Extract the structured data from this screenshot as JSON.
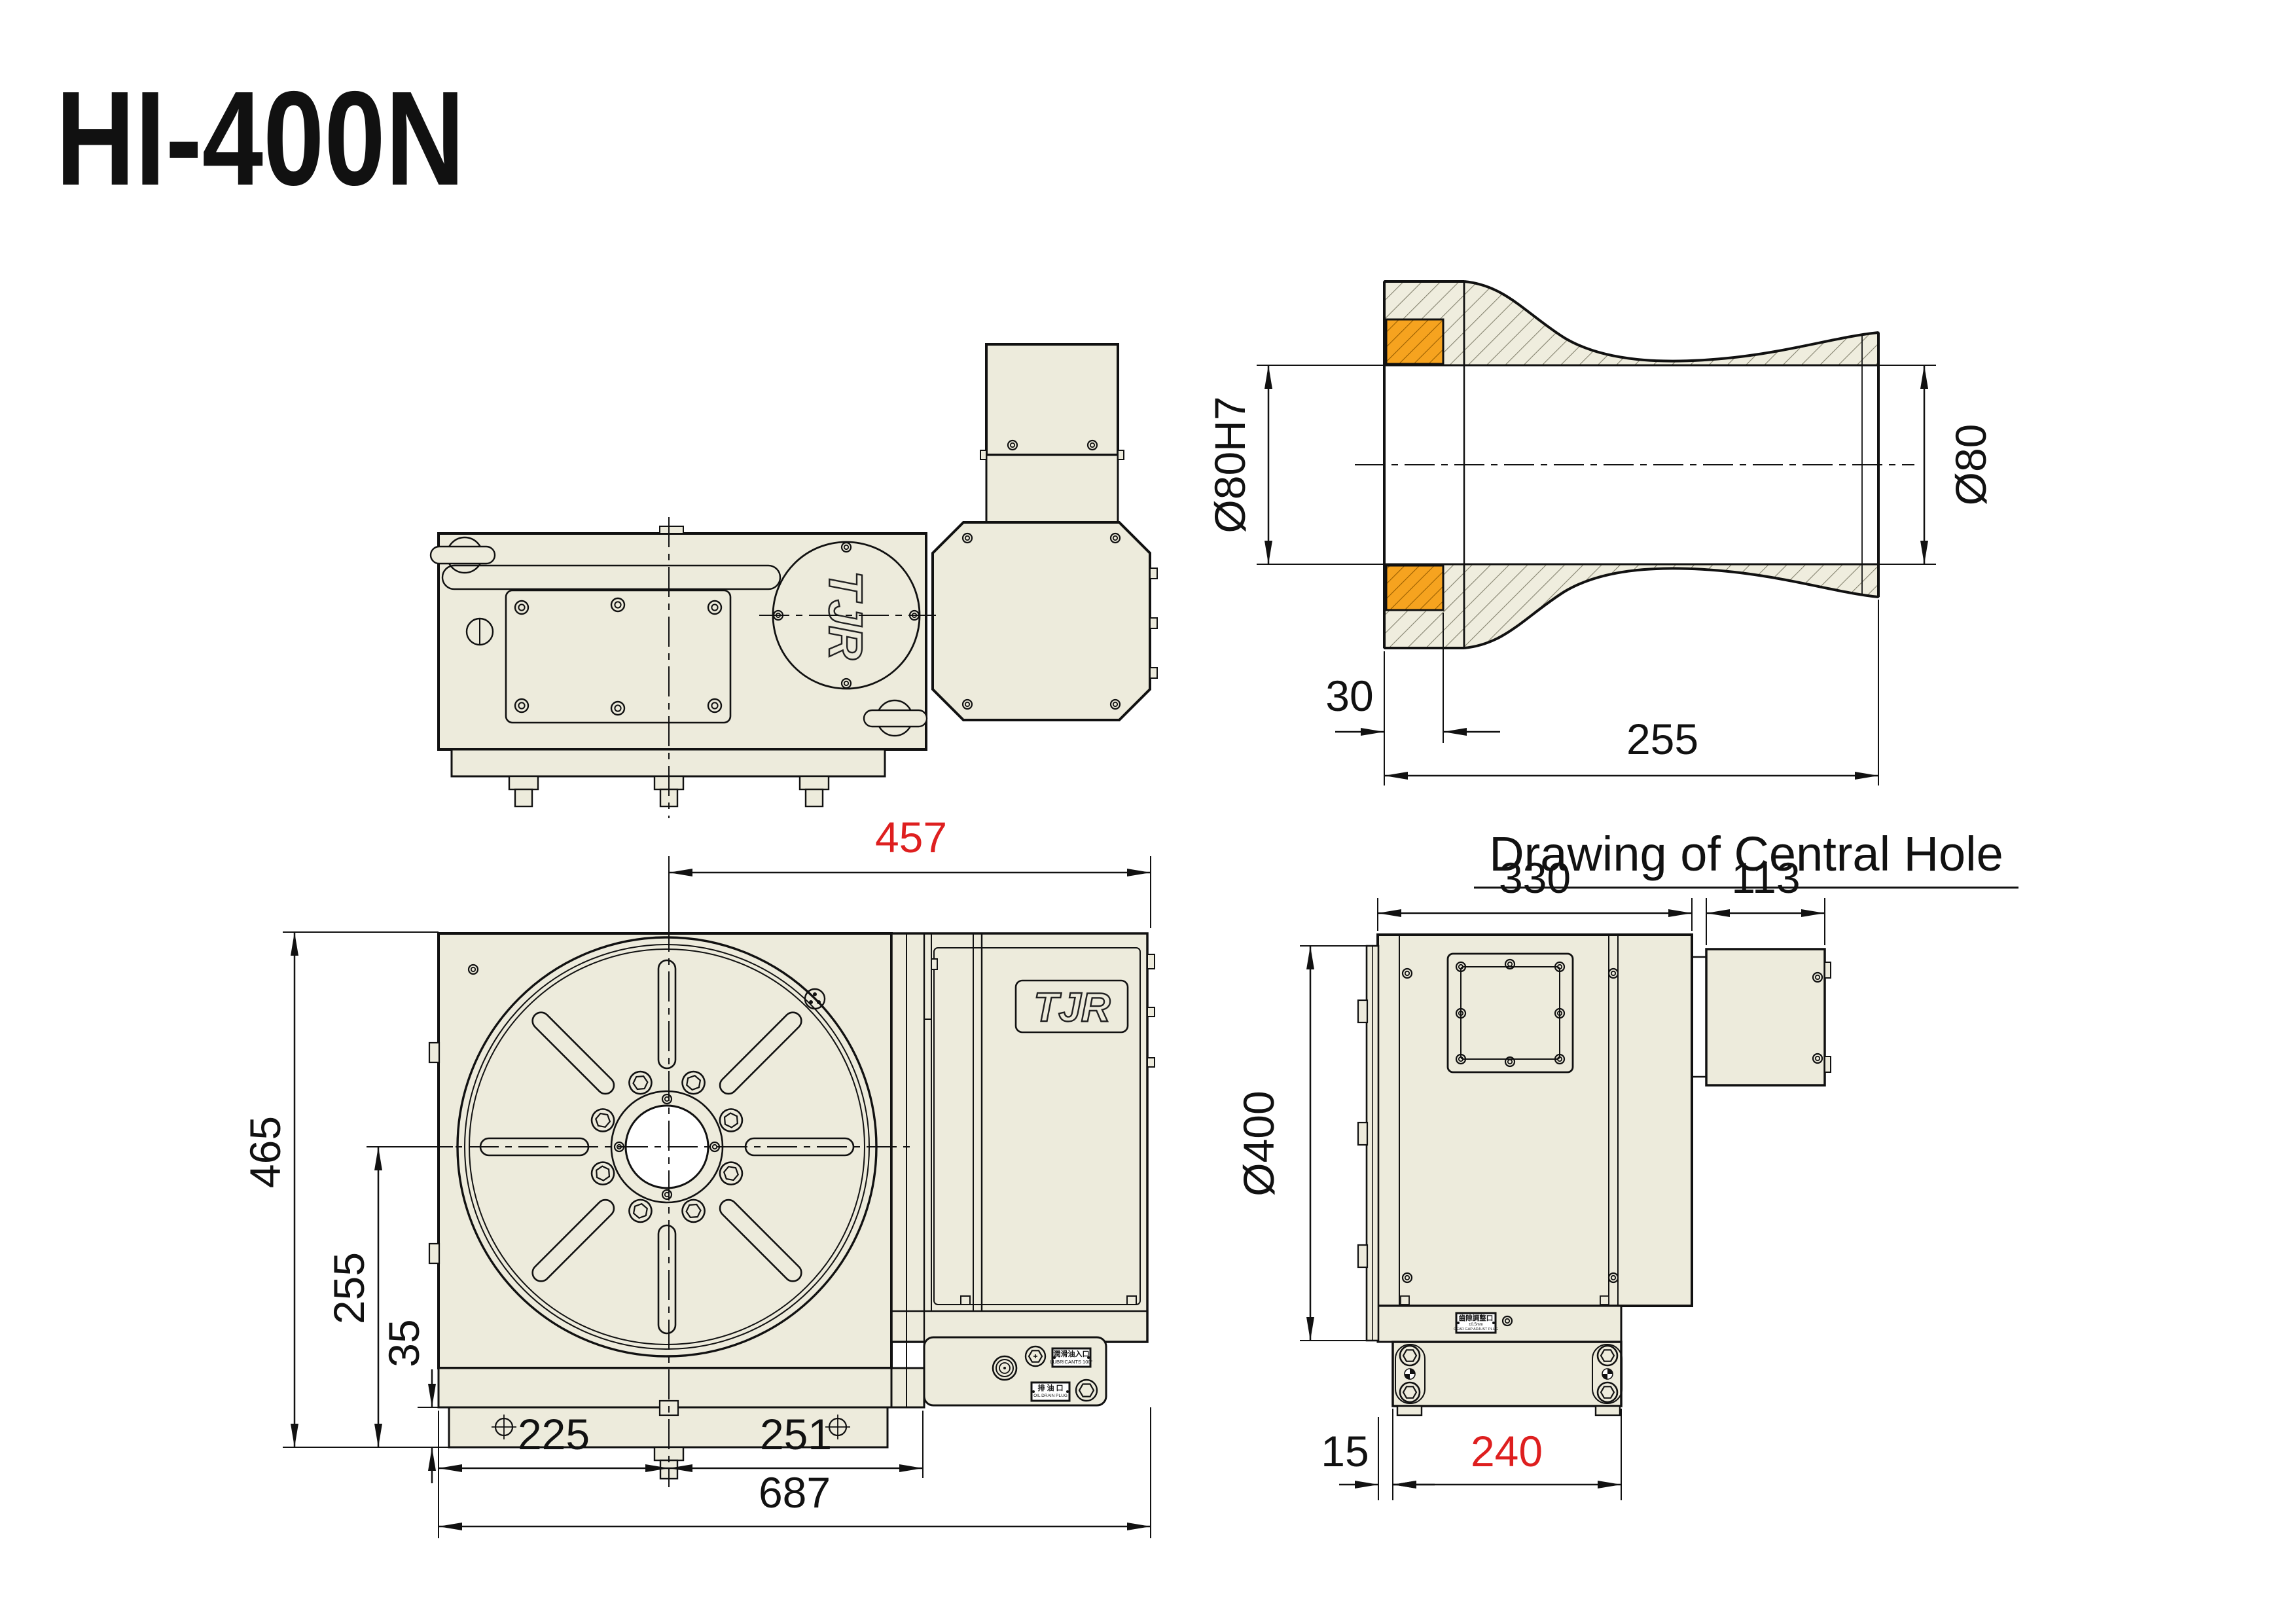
{
  "title": "HI-400N",
  "brand": "TJR",
  "colors": {
    "body_fill": "#EDEBDC",
    "tolerance_orange": "#F6A31F",
    "dim_red": "#DE1F1F",
    "line": "#111111"
  },
  "views": {
    "central_hole": {
      "caption": "Drawing of Central Hole",
      "dim_bore_h7": "Ø80H7",
      "dim_bore": "Ø80",
      "dim_depth": "30",
      "dim_length": "255"
    },
    "front": {
      "dim_width_half": "457",
      "dim_height": "465",
      "dim_center": "255",
      "dim_step": "35",
      "dim_left": "225",
      "dim_right": "251",
      "dim_total": "687"
    },
    "side": {
      "dim_body": "330",
      "dim_motor": "113",
      "dim_table": "Ø400",
      "dim_offset": "15",
      "dim_base": "240"
    }
  },
  "plates": {
    "lub_cn": "潤滑油入口",
    "lub_en": "LUBRICANTS 100°",
    "drain_cn": "排 油 口",
    "drain_en": "OIL DRAIN PLUG",
    "gear_cn": "齒隙調整口",
    "gear_tol": "±0.5mm",
    "gear_en": "GEAR GAP ADJUST PLUG"
  }
}
